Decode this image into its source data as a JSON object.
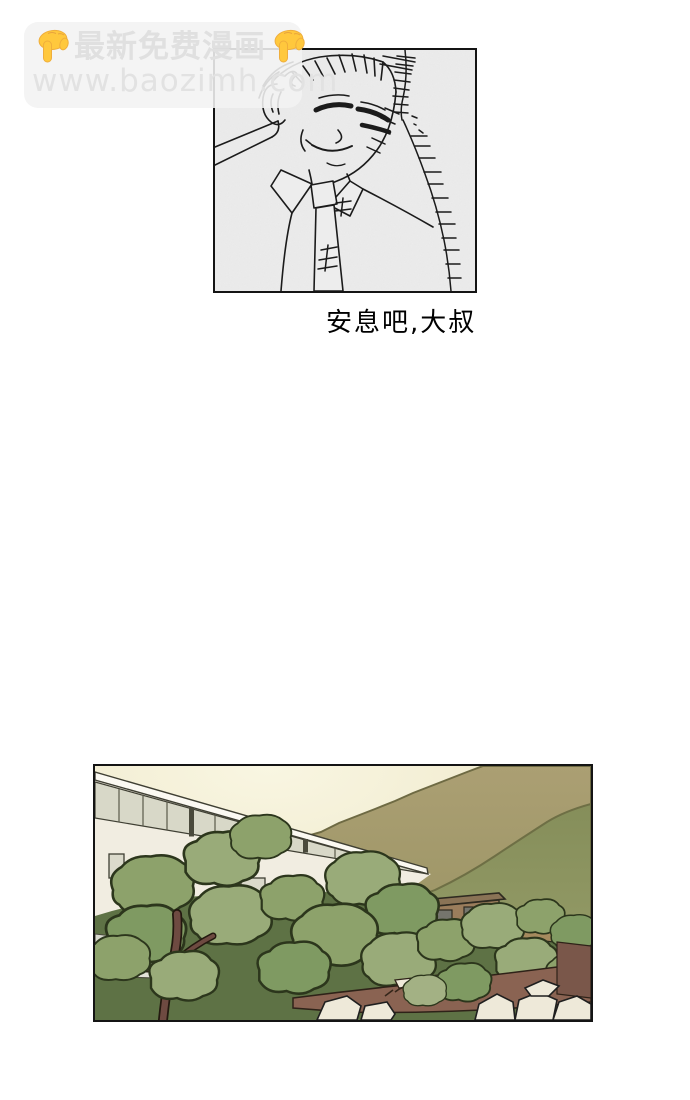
{
  "watermark": {
    "line1": "最新免费漫画",
    "line2": "www.baozimh.com",
    "icon": "point-down-emoji",
    "text_color": "#e0e0e0",
    "emoji_color": "#ffc83d"
  },
  "comic": {
    "caption": "安息吧,大叔",
    "panel1_description": "line-art close-up of a smirking man with closed eyes wearing a collared shirt and tie, crosshatch shading on the right",
    "panel2_description": "white school building with window band, olive hills, green trees, brown shed and wall, white rocks at dusk"
  },
  "colors": {
    "panel_border": "#141414",
    "panel1_background": "#ededed",
    "ink": "#1b1b1b",
    "sky": "#f8f5e0",
    "mountain_back": "#a29b6d",
    "mountain_front": "#8f955f",
    "building_wall": "#f1ede1",
    "window_band": "#d8d8c8",
    "tree_green_light": "#99ab79",
    "tree_green_mid": "#8da26b",
    "tree_green_deep": "#7f9a62",
    "tree_shadow": "#5e7245",
    "trunk_brown": "#6e4a41",
    "shed_brown": "#9b7d5c",
    "dirt_brown": "#8a6352",
    "rock_white": "#eee9d9"
  }
}
